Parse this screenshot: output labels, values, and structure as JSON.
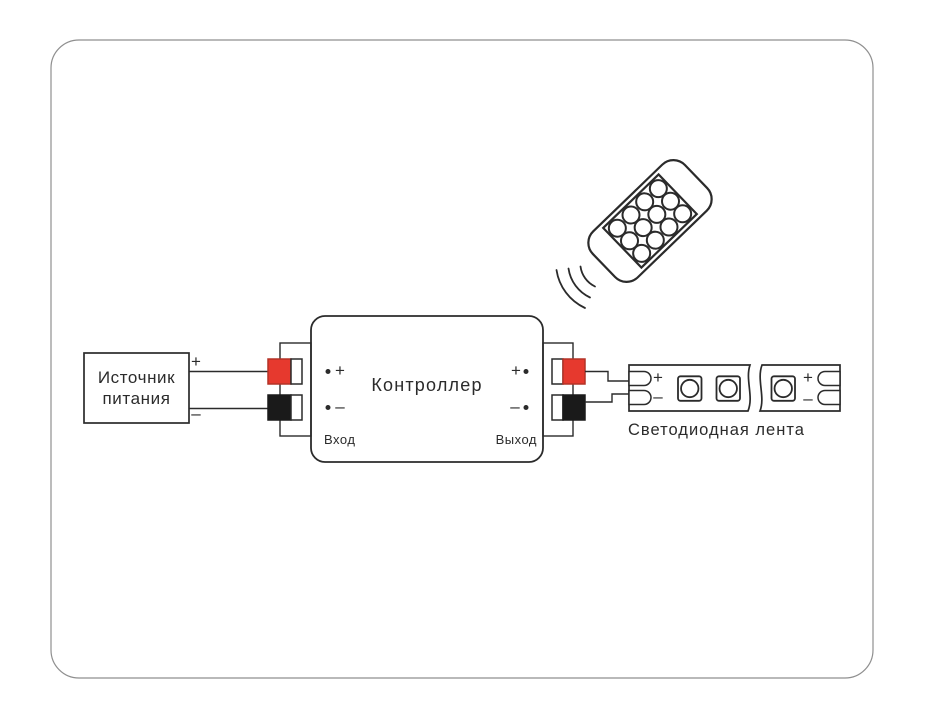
{
  "colors": {
    "line": "#2b2b2b",
    "frame": "#8f8f8f",
    "red": "#e6392e",
    "red_border": "#b43226",
    "black": "#1a1a1a"
  },
  "power_source": {
    "line1": "Источник",
    "line2": "питания",
    "plus_label": "+",
    "minus_label": "–"
  },
  "controller": {
    "title": "Контроллер",
    "input_caption": "Вход",
    "output_caption": "Выход",
    "input_plus": "+",
    "input_minus": "–",
    "output_plus": "+",
    "output_minus": "–"
  },
  "led_strip": {
    "caption": "Светодиодная лента",
    "start_plus": "+",
    "start_minus": "–",
    "end_plus": "+",
    "end_minus": "–",
    "chip_count": 3
  },
  "remote": {
    "button_count": 12,
    "button_columns": 3,
    "button_rows": 4
  }
}
